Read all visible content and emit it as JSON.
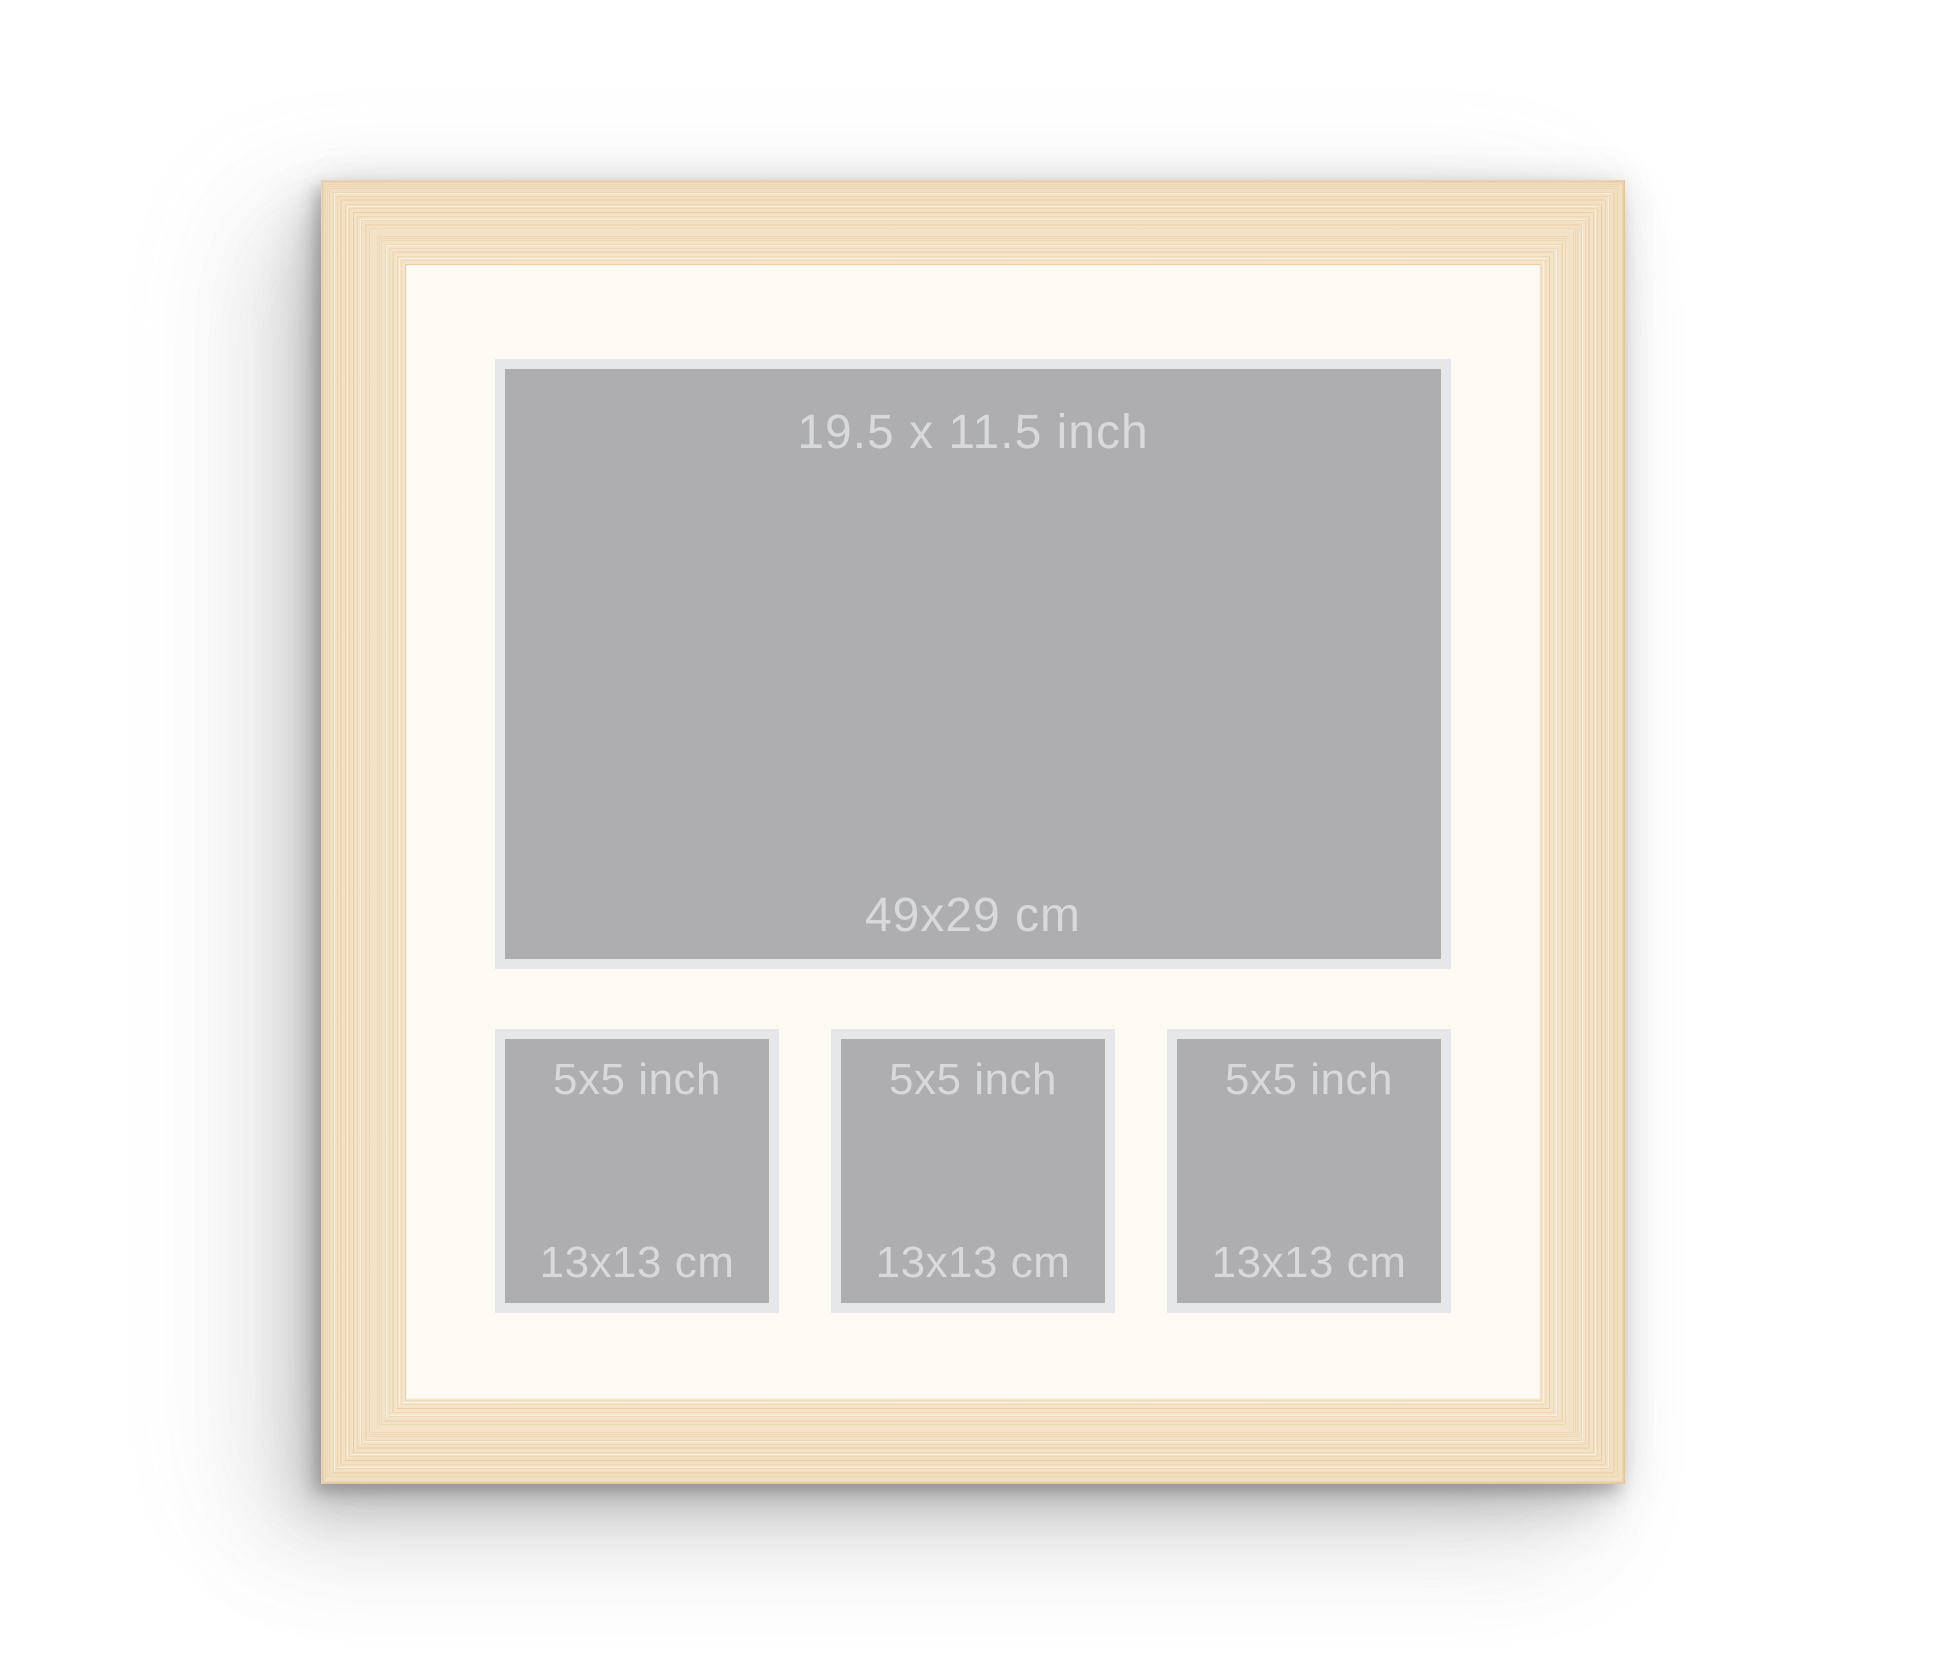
{
  "scene": {
    "description": "Wooden multi-aperture picture frame product mockup",
    "background_color": "#ffffff"
  },
  "frame": {
    "material": "light-oak-wood",
    "wood_base_color": "#f3e0c1",
    "wood_grain_dark": "#e7cba0",
    "wood_grain_light": "#faf0de",
    "wood_edge_color": "#e0c298",
    "mat_color": "#fcfaf3"
  },
  "apertures": {
    "style": {
      "fill_color": "#aeaeb0",
      "border_color": "#e6e7e9",
      "label_color": "#d8d9da"
    },
    "large": {
      "size_inch": "19.5 x 11.5 inch",
      "size_cm": "49x29 cm"
    },
    "small": [
      {
        "size_inch": "5x5 inch",
        "size_cm": "13x13 cm"
      },
      {
        "size_inch": "5x5 inch",
        "size_cm": "13x13 cm"
      },
      {
        "size_inch": "5x5 inch",
        "size_cm": "13x13 cm"
      }
    ]
  }
}
